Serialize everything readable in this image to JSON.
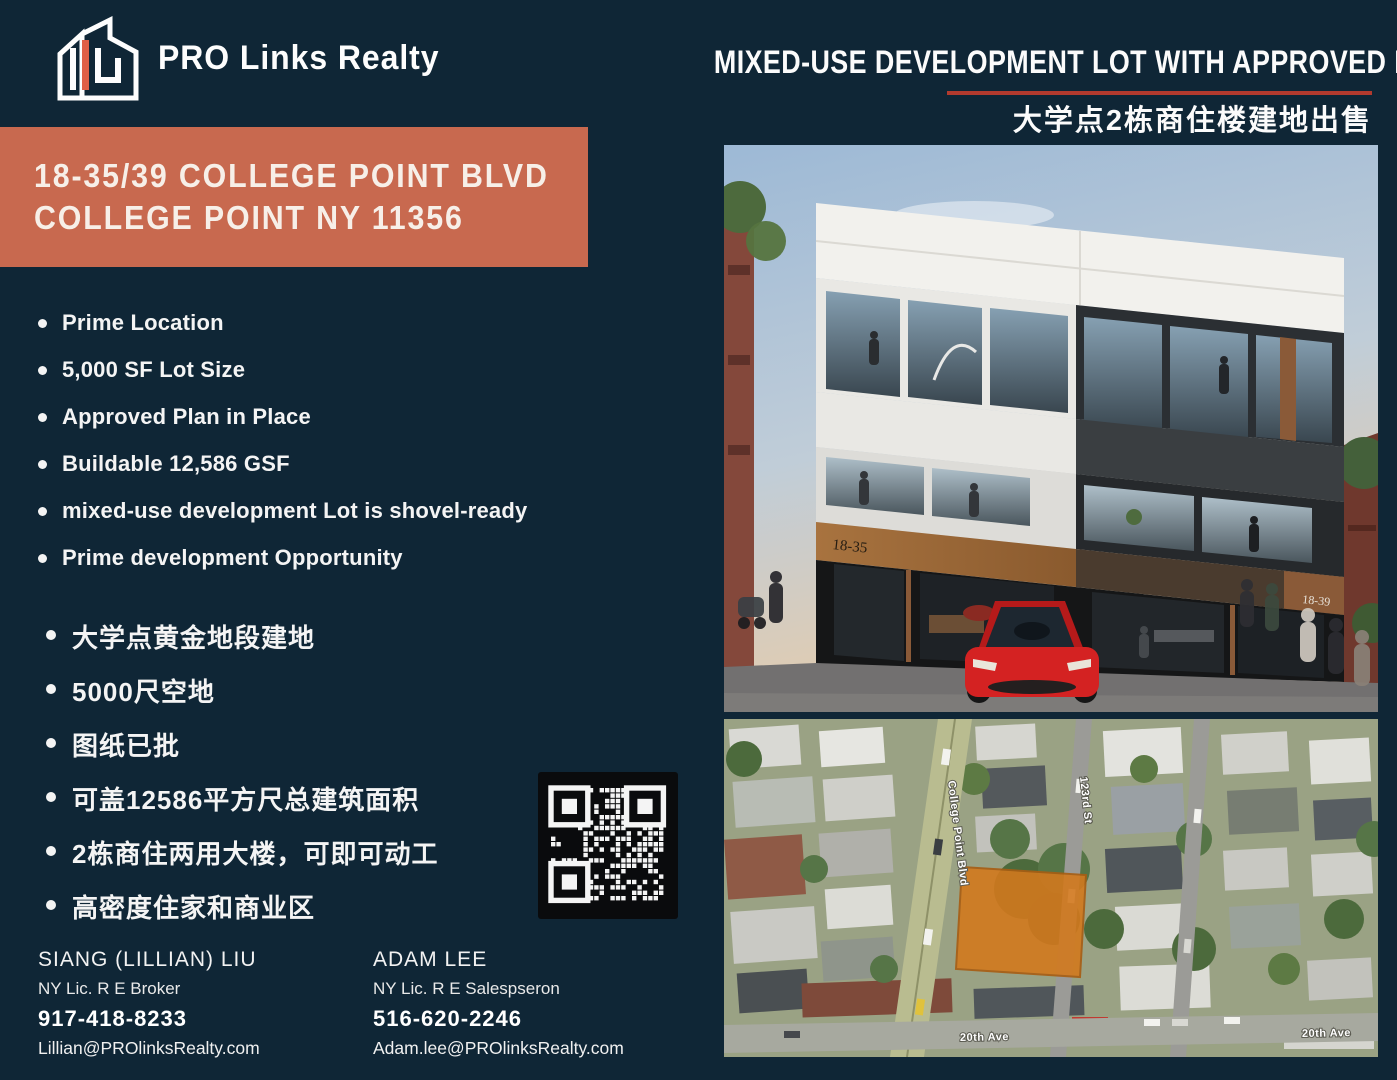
{
  "brand": {
    "name": "PRO Links Realty",
    "accent_color": "#e05f46"
  },
  "header": {
    "headline": "MIXED-USE DEVELOPMENT LOT WITH APPROVED PLAN FOR SALE",
    "headline_zh": "大学点2栋商住楼建地出售",
    "underline_color": "#b23a2e"
  },
  "address_banner": {
    "line1": "18-35/39 COLLEGE POINT BLVD",
    "line2": "COLLEGE POINT NY 11356",
    "bg_color": "#c8694f"
  },
  "features_en": [
    "Prime Location",
    "5,000 SF Lot Size",
    "Approved Plan in Place",
    "Buildable 12,586 GSF",
    "mixed-use development Lot is shovel-ready",
    "Prime development Opportunity"
  ],
  "features_zh": [
    "大学点黄金地段建地",
    "5000尺空地",
    "图纸已批",
    "可盖12586平方尺总建筑面积",
    "2栋商住两用大楼，可即可动工",
    "高密度住家和商业区"
  ],
  "contacts": [
    {
      "name": "SIANG (LILLIAN) LIU",
      "license": "NY Lic. R E Broker",
      "phone": "917-418-8233",
      "email": "Lillian@PROlinksRealty.com"
    },
    {
      "name": "ADAM LEE",
      "license": "NY Lic. R E Salespseron",
      "phone": "516-620-2246",
      "email": "Adam.lee@PROlinksRealty.com"
    }
  ],
  "rendering": {
    "building_label_left": "18-35",
    "building_label_right": "18-39"
  },
  "map": {
    "street_blvd": "College Point Blvd",
    "street_123": "123rd St",
    "ave_label_left": "20th Ave",
    "ave_label_right": "20th Ave",
    "lot_color": "#d2791e"
  }
}
